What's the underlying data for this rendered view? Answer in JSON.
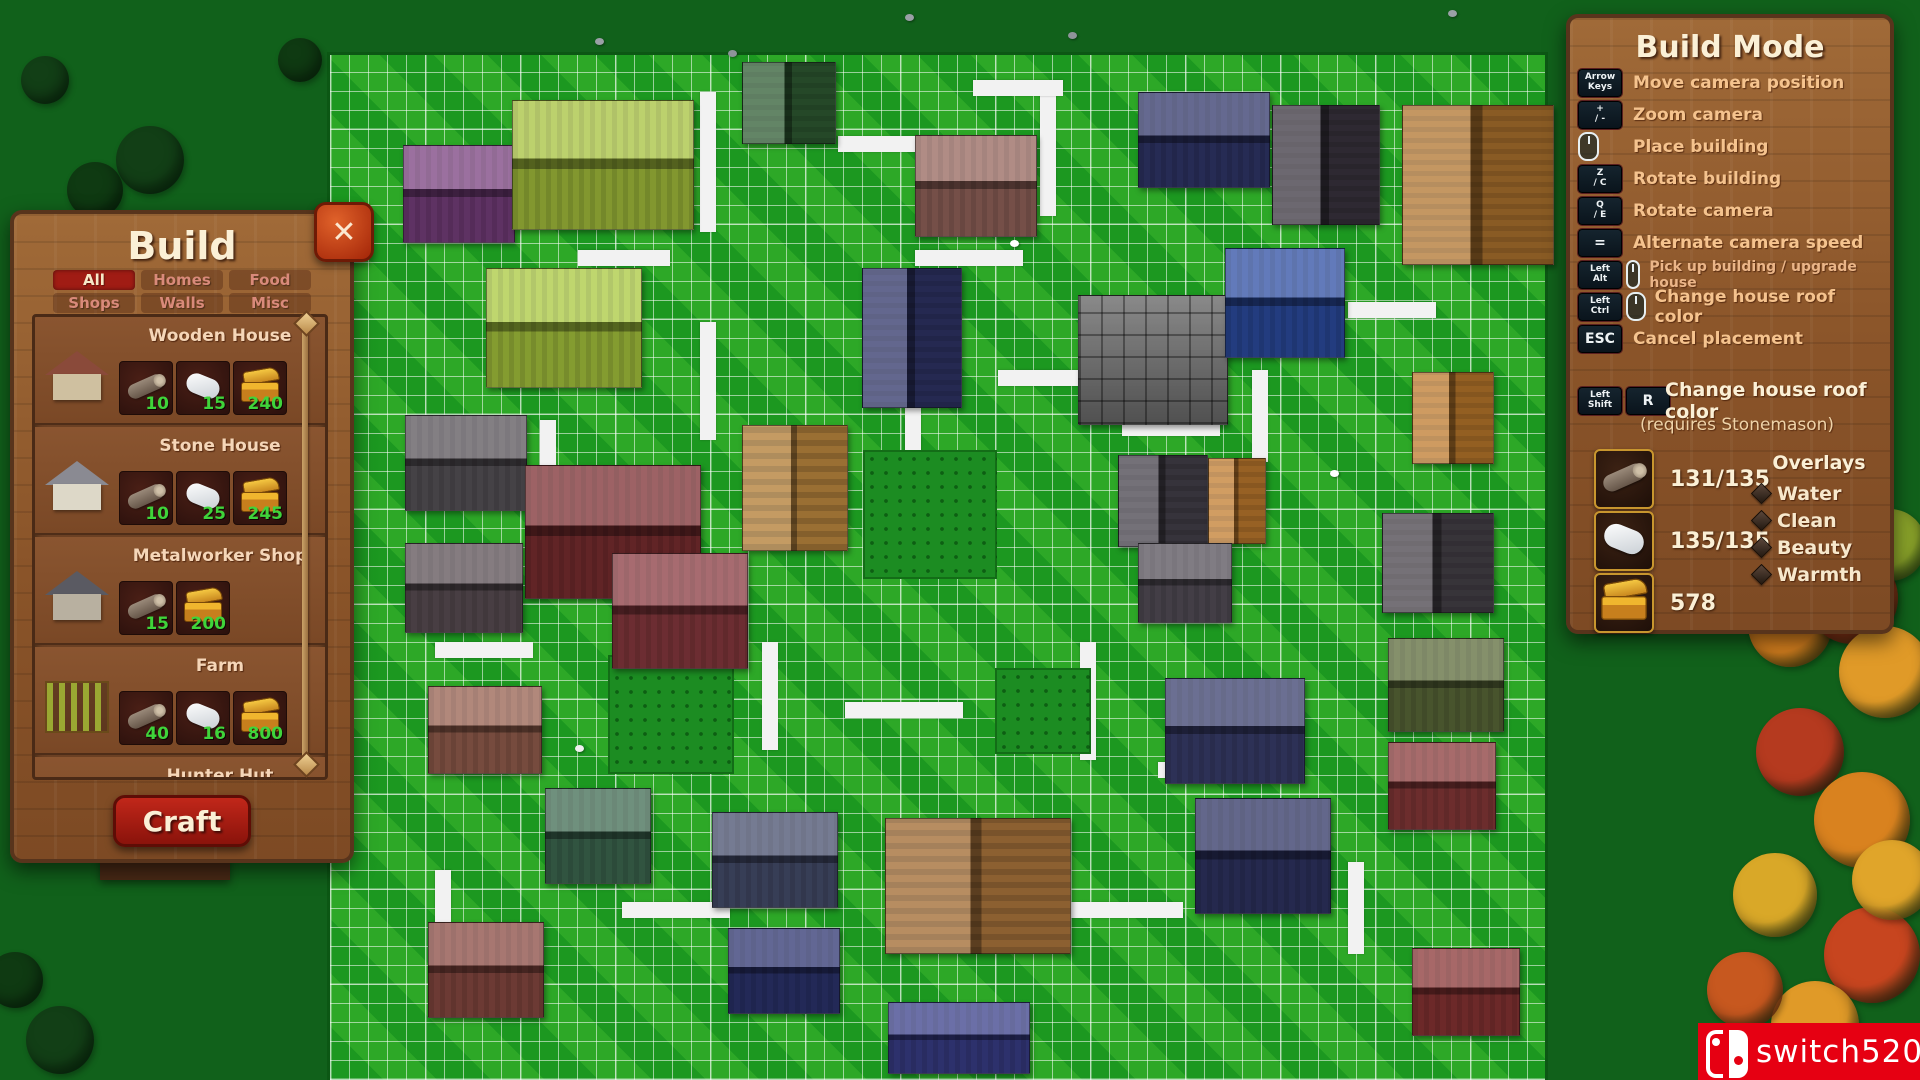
{
  "build_panel": {
    "title": "Build",
    "close_label": "✕",
    "craft_label": "Craft",
    "tabs": [
      {
        "label": "All",
        "active": true
      },
      {
        "label": "Homes",
        "active": false
      },
      {
        "label": "Food",
        "active": false
      },
      {
        "label": "Shops",
        "active": false
      },
      {
        "label": "Walls",
        "active": false
      },
      {
        "label": "Misc",
        "active": false
      }
    ],
    "items": [
      {
        "name": "Wooden House",
        "thumb": {
          "roof": "#8a4a3a",
          "wall": "#cfc0a0"
        },
        "costs": [
          {
            "icon": "log-icon",
            "value": "10"
          },
          {
            "icon": "stone-icon",
            "value": "15"
          },
          {
            "icon": "gold-chest-icon",
            "value": "240"
          }
        ]
      },
      {
        "name": "Stone House",
        "thumb": {
          "roof": "#8a8a92",
          "wall": "#ddd8c8"
        },
        "costs": [
          {
            "icon": "log-icon",
            "value": "10"
          },
          {
            "icon": "stone-icon",
            "value": "25"
          },
          {
            "icon": "gold-chest-icon",
            "value": "245"
          }
        ]
      },
      {
        "name": "Metalworker Shop",
        "thumb": {
          "roof": "#5a5a62",
          "wall": "#b8b0a0"
        },
        "costs": [
          {
            "icon": "log-icon",
            "value": "15"
          },
          {
            "icon": "gold-chest-icon",
            "value": "200"
          }
        ]
      },
      {
        "name": "Farm",
        "thumb": {
          "field": "#9aa832"
        },
        "costs": [
          {
            "icon": "log-icon",
            "value": "40"
          },
          {
            "icon": "stone-icon",
            "value": "16"
          },
          {
            "icon": "gold-chest-icon",
            "value": "800"
          }
        ]
      },
      {
        "name": "Hunter Hut",
        "thumb": null,
        "costs": []
      }
    ]
  },
  "build_mode_panel": {
    "title": "Build Mode",
    "shortcuts": [
      {
        "keys": [
          "Arrow Keys"
        ],
        "label": "Move camera position",
        "small": false
      },
      {
        "keys": [
          "+ / -"
        ],
        "label": "Zoom camera",
        "small": false
      },
      {
        "keys": [
          "mouse-icon"
        ],
        "label": "Place building",
        "small": false
      },
      {
        "keys": [
          "Z / C"
        ],
        "label": "Rotate building",
        "small": false
      },
      {
        "keys": [
          "Q / E"
        ],
        "label": "Rotate camera",
        "small": false
      },
      {
        "keys": [
          "="
        ],
        "label": "Alternate camera speed",
        "small": false
      },
      {
        "keys": [
          "Left Alt",
          "mouse-icon"
        ],
        "label": "Pick up building / upgrade house",
        "small": true
      },
      {
        "keys": [
          "Left Ctrl",
          "mouse-icon"
        ],
        "label": "Change house roof color",
        "small": false
      },
      {
        "keys": [
          "ESC"
        ],
        "label": "Cancel placement",
        "small": false
      }
    ],
    "roof_shortcut": {
      "keys": [
        "Left Shift",
        "R"
      ],
      "label": "Change house roof color",
      "note": "(requires Stonemason)"
    },
    "resources": [
      {
        "icon": "log-icon",
        "value": "131/135"
      },
      {
        "icon": "stone-icon",
        "value": "135/135"
      },
      {
        "icon": "gold-chest-icon",
        "value": "578"
      }
    ],
    "overlays": {
      "title": "Overlays",
      "items": [
        "Water",
        "Clean",
        "Beauty",
        "Warmth"
      ]
    }
  },
  "watermark": {
    "text": "switch520",
    "color": "#e60012",
    "logo": "nintendo-switch-logo"
  },
  "map": {
    "palette": {
      "grid_green": "#1fa124",
      "dark_green": "#11611b",
      "road_white": "#f2f2f2"
    },
    "buildings": [
      {
        "x": 742,
        "y": 62,
        "w": 92,
        "h": 80,
        "c": "#2f5c33",
        "r": "v"
      },
      {
        "x": 403,
        "y": 145,
        "w": 110,
        "h": 96,
        "c": "#79407f",
        "r": "h"
      },
      {
        "x": 512,
        "y": 100,
        "w": 180,
        "h": 128,
        "c": "#a6c23c",
        "r": "h"
      },
      {
        "x": 915,
        "y": 135,
        "w": 120,
        "h": 100,
        "c": "#96655c",
        "r": "h"
      },
      {
        "x": 1138,
        "y": 92,
        "w": 130,
        "h": 94,
        "c": "#31376b",
        "r": "h"
      },
      {
        "x": 1272,
        "y": 105,
        "w": 106,
        "h": 118,
        "c": "#3b3540",
        "r": "v"
      },
      {
        "x": 1402,
        "y": 105,
        "w": 150,
        "h": 158,
        "c": "#b0742e",
        "r": "v"
      },
      {
        "x": 486,
        "y": 268,
        "w": 154,
        "h": 118,
        "c": "#a9c83e",
        "r": "h"
      },
      {
        "x": 405,
        "y": 415,
        "w": 120,
        "h": 94,
        "c": "#59545a",
        "r": "h"
      },
      {
        "x": 405,
        "y": 543,
        "w": 116,
        "h": 88,
        "c": "#5c5056",
        "r": "h"
      },
      {
        "x": 525,
        "y": 465,
        "w": 174,
        "h": 132,
        "c": "#7c2e31",
        "r": "h"
      },
      {
        "x": 862,
        "y": 268,
        "w": 98,
        "h": 138,
        "c": "#2f3468",
        "r": "v"
      },
      {
        "x": 1078,
        "y": 295,
        "w": 148,
        "h": 128,
        "c": "#6f6f6f",
        "t": "stone"
      },
      {
        "x": 1225,
        "y": 248,
        "w": 118,
        "h": 108,
        "c": "#2d4da3",
        "r": "h"
      },
      {
        "x": 1412,
        "y": 372,
        "w": 80,
        "h": 90,
        "c": "#bd7a2c",
        "r": "v"
      },
      {
        "x": 1118,
        "y": 455,
        "w": 88,
        "h": 90,
        "c": "#45414b",
        "r": "v"
      },
      {
        "x": 1208,
        "y": 458,
        "w": 56,
        "h": 84,
        "c": "#c27c2e",
        "r": "v"
      },
      {
        "x": 1382,
        "y": 513,
        "w": 110,
        "h": 98,
        "c": "#474249",
        "r": "v"
      },
      {
        "x": 742,
        "y": 425,
        "w": 104,
        "h": 124,
        "c": "#b5823c",
        "t": "planks"
      },
      {
        "x": 612,
        "y": 553,
        "w": 134,
        "h": 114,
        "c": "#8a3a40",
        "r": "h"
      },
      {
        "x": 428,
        "y": 686,
        "w": 112,
        "h": 86,
        "c": "#97604f",
        "r": "h"
      },
      {
        "x": 545,
        "y": 788,
        "w": 104,
        "h": 94,
        "c": "#3f6b52",
        "r": "h"
      },
      {
        "x": 428,
        "y": 922,
        "w": 114,
        "h": 94,
        "c": "#8a4a42",
        "r": "h"
      },
      {
        "x": 712,
        "y": 812,
        "w": 124,
        "h": 94,
        "c": "#474f6e",
        "r": "h"
      },
      {
        "x": 885,
        "y": 818,
        "w": 184,
        "h": 134,
        "c": "#a5713a",
        "t": "planks"
      },
      {
        "x": 888,
        "y": 1002,
        "w": 140,
        "h": 70,
        "c": "#3a3f8a",
        "r": "h"
      },
      {
        "x": 1165,
        "y": 678,
        "w": 138,
        "h": 104,
        "c": "#3a3f6e",
        "r": "h"
      },
      {
        "x": 1195,
        "y": 798,
        "w": 134,
        "h": 114,
        "c": "#2f3464",
        "r": "h"
      },
      {
        "x": 1388,
        "y": 638,
        "w": 114,
        "h": 92,
        "c": "#5c6b3a",
        "r": "h"
      },
      {
        "x": 1388,
        "y": 742,
        "w": 106,
        "h": 86,
        "c": "#8a3a3a",
        "r": "h"
      },
      {
        "x": 1412,
        "y": 948,
        "w": 106,
        "h": 86,
        "c": "#8a3535",
        "r": "h"
      },
      {
        "x": 728,
        "y": 928,
        "w": 110,
        "h": 84,
        "c": "#2d3470",
        "r": "h"
      },
      {
        "x": 1138,
        "y": 543,
        "w": 92,
        "h": 78,
        "c": "#56505a",
        "r": "h"
      }
    ],
    "fields": [
      {
        "x": 863,
        "y": 450,
        "w": 130,
        "h": 125
      },
      {
        "x": 608,
        "y": 655,
        "w": 122,
        "h": 115
      },
      {
        "x": 995,
        "y": 668,
        "w": 92,
        "h": 82
      }
    ],
    "roads": [
      {
        "x": 700,
        "y": 92,
        "w": 16,
        "h": 140
      },
      {
        "x": 838,
        "y": 136,
        "w": 88,
        "h": 16
      },
      {
        "x": 1040,
        "y": 88,
        "w": 16,
        "h": 128
      },
      {
        "x": 915,
        "y": 250,
        "w": 108,
        "h": 16
      },
      {
        "x": 700,
        "y": 322,
        "w": 16,
        "h": 118
      },
      {
        "x": 578,
        "y": 250,
        "w": 92,
        "h": 16
      },
      {
        "x": 905,
        "y": 382,
        "w": 16,
        "h": 102
      },
      {
        "x": 998,
        "y": 370,
        "w": 118,
        "h": 16
      },
      {
        "x": 1252,
        "y": 370,
        "w": 16,
        "h": 92
      },
      {
        "x": 1348,
        "y": 302,
        "w": 88,
        "h": 16
      },
      {
        "x": 1122,
        "y": 420,
        "w": 98,
        "h": 16
      },
      {
        "x": 762,
        "y": 642,
        "w": 16,
        "h": 108
      },
      {
        "x": 845,
        "y": 702,
        "w": 118,
        "h": 16
      },
      {
        "x": 1080,
        "y": 642,
        "w": 16,
        "h": 118
      },
      {
        "x": 1158,
        "y": 762,
        "w": 108,
        "h": 16
      },
      {
        "x": 435,
        "y": 642,
        "w": 98,
        "h": 16
      },
      {
        "x": 1348,
        "y": 862,
        "w": 16,
        "h": 92
      },
      {
        "x": 622,
        "y": 902,
        "w": 108,
        "h": 16
      },
      {
        "x": 1065,
        "y": 902,
        "w": 118,
        "h": 16
      },
      {
        "x": 435,
        "y": 870,
        "w": 16,
        "h": 92
      },
      {
        "x": 540,
        "y": 420,
        "w": 16,
        "h": 95
      },
      {
        "x": 973,
        "y": 80,
        "w": 90,
        "h": 16
      }
    ],
    "trees": [
      {
        "x": 1745,
        "y": 565,
        "r": 34,
        "c": "#3f7a23"
      },
      {
        "x": 1790,
        "y": 625,
        "r": 42,
        "c": "#d9821f"
      },
      {
        "x": 1852,
        "y": 598,
        "r": 46,
        "c": "#c7451f"
      },
      {
        "x": 1885,
        "y": 672,
        "r": 46,
        "c": "#e09a28"
      },
      {
        "x": 1800,
        "y": 752,
        "r": 44,
        "c": "#b53a1f"
      },
      {
        "x": 1862,
        "y": 820,
        "r": 48,
        "c": "#d9821f"
      },
      {
        "x": 1775,
        "y": 895,
        "r": 42,
        "c": "#d9a828"
      },
      {
        "x": 1872,
        "y": 955,
        "r": 48,
        "c": "#c7451f"
      },
      {
        "x": 1815,
        "y": 1025,
        "r": 44,
        "c": "#e09a28"
      },
      {
        "x": 1890,
        "y": 545,
        "r": 36,
        "c": "#8aa32a"
      },
      {
        "x": 1745,
        "y": 990,
        "r": 38,
        "c": "#c7581f"
      },
      {
        "x": 1892,
        "y": 880,
        "r": 40,
        "c": "#e0a52a"
      },
      {
        "x": 150,
        "y": 160,
        "r": 34,
        "c": "#123f16"
      },
      {
        "x": 95,
        "y": 190,
        "r": 28,
        "c": "#0f3a12"
      },
      {
        "x": 60,
        "y": 1040,
        "r": 34,
        "c": "#123f16"
      },
      {
        "x": 15,
        "y": 980,
        "r": 28,
        "c": "#0f3a12"
      },
      {
        "x": 300,
        "y": 60,
        "r": 22,
        "c": "#0f3a12"
      },
      {
        "x": 45,
        "y": 80,
        "r": 24,
        "c": "#123f16"
      }
    ],
    "props": [
      {
        "x": 595,
        "y": 38,
        "c": "#9aa0a6"
      },
      {
        "x": 728,
        "y": 50,
        "c": "#8e949a"
      },
      {
        "x": 905,
        "y": 14,
        "c": "#9aa0a6"
      },
      {
        "x": 1068,
        "y": 32,
        "c": "#8e949a"
      },
      {
        "x": 1448,
        "y": 10,
        "c": "#9aa0a6"
      },
      {
        "x": 88,
        "y": 852,
        "c": "#e8e8e8"
      },
      {
        "x": 575,
        "y": 745,
        "c": "#f0f0f0"
      },
      {
        "x": 1010,
        "y": 240,
        "c": "#ffffff"
      },
      {
        "x": 1330,
        "y": 470,
        "c": "#ffffff"
      }
    ]
  }
}
